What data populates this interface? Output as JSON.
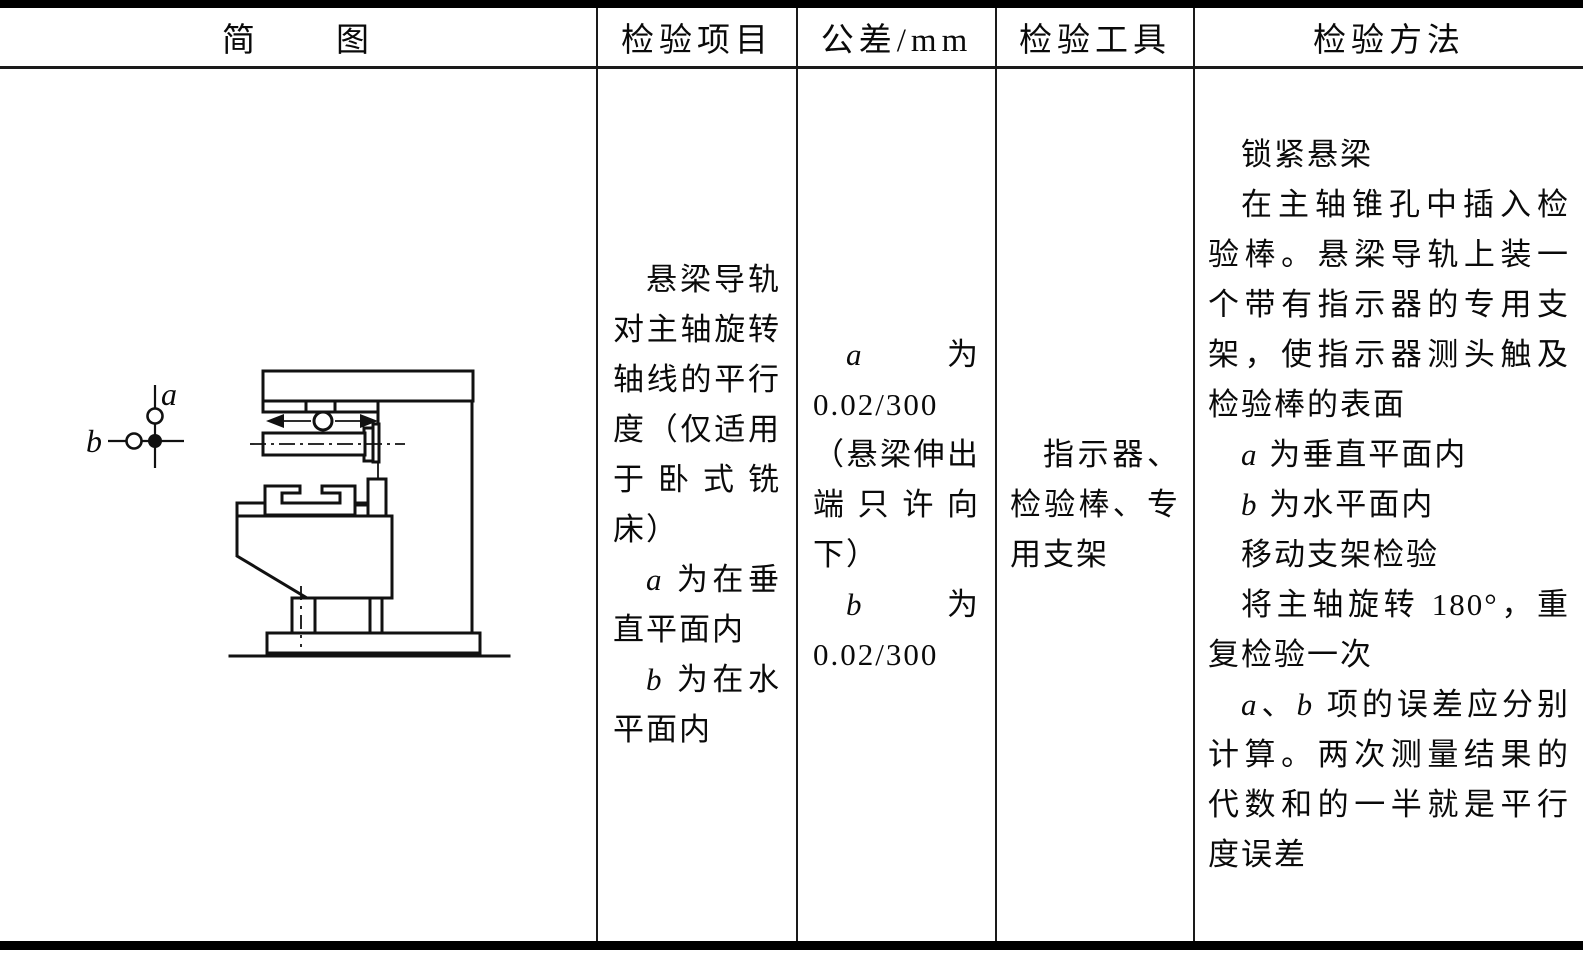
{
  "table": {
    "header": [
      {
        "label": "简　　图"
      },
      {
        "label": "检验项目"
      },
      {
        "label": "公差/mm"
      },
      {
        "label": "检验工具"
      },
      {
        "label": "检验方法"
      }
    ],
    "row": {
      "item": {
        "paragraphs": [
          {
            "runs": [
              {
                "t": "悬梁导轨对主轴旋转轴线的平行度（仅适用于卧式铣床）"
              }
            ]
          },
          {
            "runs": [
              {
                "t": "a",
                "i": true
              },
              {
                "t": " 为在垂直平面内"
              }
            ]
          },
          {
            "runs": [
              {
                "t": "b",
                "i": true
              },
              {
                "t": " 为在水平面内"
              }
            ]
          }
        ]
      },
      "tolerance": {
        "paragraphs": [
          {
            "runs": [
              {
                "t": "a",
                "i": true
              },
              {
                "t": " 为 0.02/300（悬梁伸出端只许向下）"
              }
            ]
          },
          {
            "runs": [
              {
                "t": "b",
                "i": true
              },
              {
                "t": " 为 0.02/300"
              }
            ]
          }
        ]
      },
      "tools": {
        "paragraphs": [
          {
            "runs": [
              {
                "t": "指示器、检验棒、专用支架"
              }
            ]
          }
        ]
      },
      "method": {
        "paragraphs": [
          {
            "runs": [
              {
                "t": "锁紧悬梁"
              }
            ]
          },
          {
            "runs": [
              {
                "t": "在主轴锥孔中插入检验棒。悬梁导轨上装一个带有指示器的专用支架，使指示器测头触及检验棒的表面"
              }
            ]
          },
          {
            "runs": [
              {
                "t": "a",
                "i": true
              },
              {
                "t": " 为垂直平面内"
              }
            ]
          },
          {
            "runs": [
              {
                "t": "b",
                "i": true
              },
              {
                "t": " 为水平面内"
              }
            ]
          },
          {
            "runs": [
              {
                "t": "移动支架检验"
              }
            ]
          },
          {
            "runs": [
              {
                "t": "将主轴旋转 180°，重复检验一次"
              }
            ]
          },
          {
            "runs": [
              {
                "t": "a",
                "i": true
              },
              {
                "t": "、"
              },
              {
                "t": "b",
                "i": true
              },
              {
                "t": " 项的误差应分别计算。两次测量结果的代数和的一半就是平行度误差"
              }
            ]
          }
        ]
      }
    },
    "diagram": {
      "direction_labels": {
        "a": "a",
        "b": "b"
      }
    }
  },
  "colors": {
    "line": "#111111",
    "background": "#ffffff"
  }
}
